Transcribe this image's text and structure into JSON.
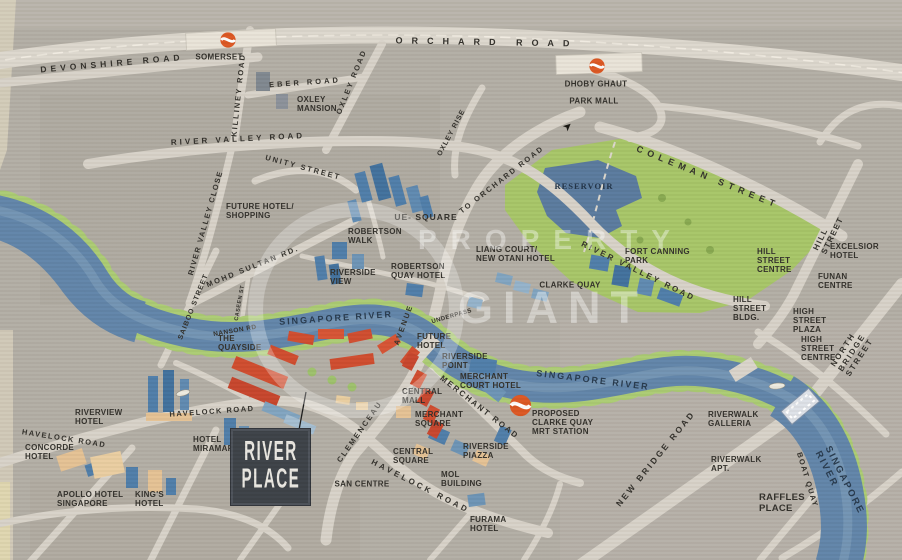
{
  "logo": {
    "line1": "RIVER",
    "line2": "PLACE"
  },
  "watermark": {
    "word1": "PROPERTY",
    "word2": "GIANT"
  },
  "colors": {
    "background": "#b2ada4",
    "road": "#d7d2c8",
    "river": "#5f83a8",
    "park": "#a6c566",
    "reservoir": "#58799d",
    "tree_fringe": "#aacb72",
    "building_blue": "#4d7ca8",
    "building_tan": "#e4c193",
    "river_place_red": "#cf4a2c",
    "mrt_orange": "#dc5520",
    "logo_box": "#3a3f45"
  },
  "labels": {
    "orchard_road": "ORCHARD ROAD",
    "devonshire_road": "DEVONSHIRE ROAD",
    "somerset": "SOMERSET",
    "killiney_road": "KILLINEY ROAD",
    "eber_road": "EBER ROAD",
    "oxley_road": "OXLEY ROAD",
    "oxley_mansion": "OXLEY\nMANSION",
    "oxley_rise": "OXLEY RISE",
    "dhoby_ghaut": "DHOBY GHAUT",
    "park_mall": "PARK MALL",
    "river_valley_road_west": "RIVER VALLEY ROAD",
    "unity_street": "UNITY STREET",
    "river_valley_close": "RIVER VALLEY CLOSE",
    "to_orchard_road": "TO ORCHARD ROAD",
    "coleman_street": "COLEMAN STREET",
    "reservoir": "RESERVOIR",
    "fort_canning_park": "FORT CANNING\nPARK",
    "hill_street": "HILL STREET",
    "excelsior_hotel": "EXCELSIOR\nHOTEL",
    "funan_centre": "FUNAN\nCENTRE",
    "hill_street_centre": "HILL\nSTREET\nCENTRE",
    "hill_street_bldg": "HILL\nSTREET\nBLDG.",
    "high_street_plaza": "HIGH\nSTREET\nPLAZA",
    "high_street_centre": "HIGH\nSTREET\nCENTRE",
    "north_bridge_street": "NORTH BRIDGE STREET",
    "future_hotel_shopping": "FUTURE HOTEL/\nSHOPPING",
    "mohd_sultan_rd": "MOHD SULTAN RD.",
    "saiboo_street": "SAIBOO STREET",
    "caseen_st": "CASEEN ST",
    "nanson_rd": "NANSON RD",
    "the_quayside": "THE\nQUAYSIDE",
    "ue_square": "UE- SQUARE",
    "robertson_walk": "ROBERTSON\nWALK",
    "riverside_view": "RIVERSIDE\nVIEW",
    "robertson_quay_hotel": "ROBERTSON\nQUAY HOTEL",
    "liang_court_new_otani": "LIANG COURT/\nNEW OTANI HOTEL",
    "clarke_quay": "CLARKE QUAY",
    "river_valley_road_east": "RIVER VALLEY ROAD",
    "underpass": "UNDERPASS",
    "singapore_river_mid": "SINGAPORE RIVER",
    "singapore_river_east": "SINGAPORE RIVER",
    "singapore_river_south": "SINGAPORE RIVER",
    "boat_quay": "BOAT QUAY",
    "clemenceau_avenue_1": "CLEMENCEAU",
    "clemenceau_avenue_2": "AVENUE",
    "future_hotel": "FUTURE\nHOTEL",
    "riverside_point": "RIVERSIDE\nPOINT",
    "merchant_court_hotel": "MERCHANT\nCOURT HOTEL",
    "central_mall": "CENTRAL\nMALL",
    "merchant_square": "MERCHANT\nSQUARE",
    "merchant_road": "MERCHANT ROAD",
    "proposed_clarke_quay_mrt": "PROPOSED\nCLARKE QUAY\nMRT STATION",
    "new_bridge_road": "NEW BRIDGE ROAD",
    "riverwalk_galleria": "RIVERWALK\nGALLERIA",
    "riverwalk_apt": "RIVERWALK\nAPT.",
    "raffles_place": "RAFFLES\nPLACE",
    "havelock_road_west": "HAVELOCK ROAD",
    "havelock_road_mid": "HAVELOCK ROAD",
    "havelock_road_south": "HAVELOCK ROAD",
    "riverview_hotel": "RIVERVIEW\nHOTEL",
    "concorde_hotel": "CONCORDE\nHOTEL",
    "hotel_miramar": "HOTEL\nMIRAMAR",
    "apollo_hotel": "APOLLO HOTEL\nSINGAPORE",
    "kings_hotel": "KING'S\nHOTEL",
    "san_centre": "SAN CENTRE",
    "central_square": "CENTRAL\nSQUARE",
    "mol_building": "MOL\nBUILDING",
    "riverside_piazza": "RIVERSIDE\nPIAZZA",
    "furama_hotel": "FURAMA\nHOTEL"
  }
}
